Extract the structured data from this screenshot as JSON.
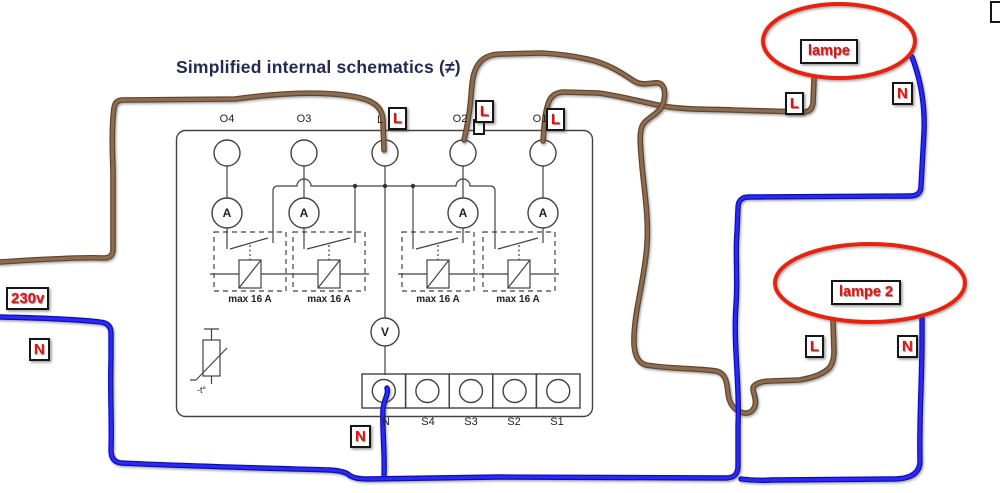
{
  "title": "Simplified internal schematics (≠)",
  "device": {
    "top_terminals": [
      "O4",
      "O3",
      "L",
      "O2",
      "O1"
    ],
    "bottom_terminals": [
      "N",
      "S4",
      "S3",
      "S2",
      "S1"
    ],
    "ammeter_label": "A",
    "voltmeter_label": "V",
    "fuse_label": "max 16 A",
    "thermistor_label": "-t°"
  },
  "labels": {
    "supply_voltage": "230v",
    "neutral": "N",
    "live": "L",
    "lamp1": "lampe",
    "lamp2": "lampe 2"
  },
  "colors": {
    "live_wire_brown": "#8f6c4c",
    "neutral_wire_blue": "#2a2af2",
    "highlight_red": "#e9230e",
    "badge_text_red": "#f10c0c",
    "title_navy": "#232a54",
    "schematic_gray": "#424242"
  }
}
